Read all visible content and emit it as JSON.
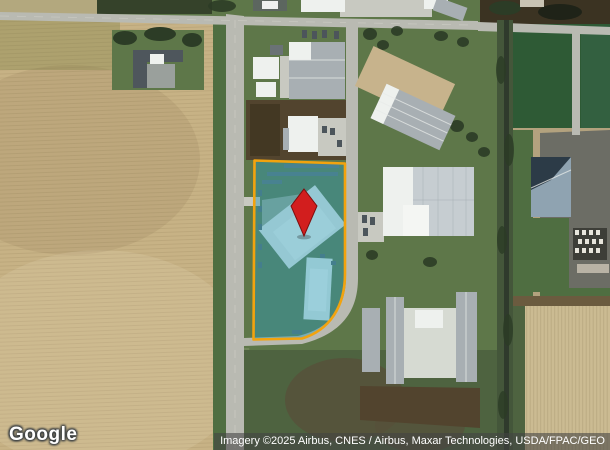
{
  "map": {
    "view_type": "satellite-imagery",
    "logo_text": "Google",
    "attribution_text": "Imagery ©2025 Airbus, CNES / Airbus, Maxar Technologies, USDA/FPAC/GEO"
  },
  "overlay": {
    "parcel_boundary": "highlighted property parcel with rounded south-east corner",
    "pin_marker": "red diamond location pin inside parcel"
  },
  "theme": {
    "grass": "#5e7749",
    "grass_dark": "#4f6e41",
    "field_tan": "#c7b285",
    "field_tan_light": "#cbbb92",
    "road": "#b9bab2",
    "road_light": "#c8c9c1",
    "dirt": "#52442e",
    "scrub": "#4e6340",
    "rail_brush": "#44563a",
    "rail_line": "#2f3a2c",
    "tree": "#2c3c26",
    "asphalt": "#6c6d65",
    "bld_white": "#eef1ee",
    "bld_gray": "#a8afb3",
    "bld_light": "#c6cdd1",
    "barn_roof": "#8fa3b1",
    "barn_shadow": "#2c3b47",
    "field_green_e": "#2e5a35",
    "parcel_fill": "#2e9bb5",
    "parcel_stroke": "#f2a30e",
    "pin": "#d21e1e",
    "pin_dark": "#7e0e0e"
  }
}
